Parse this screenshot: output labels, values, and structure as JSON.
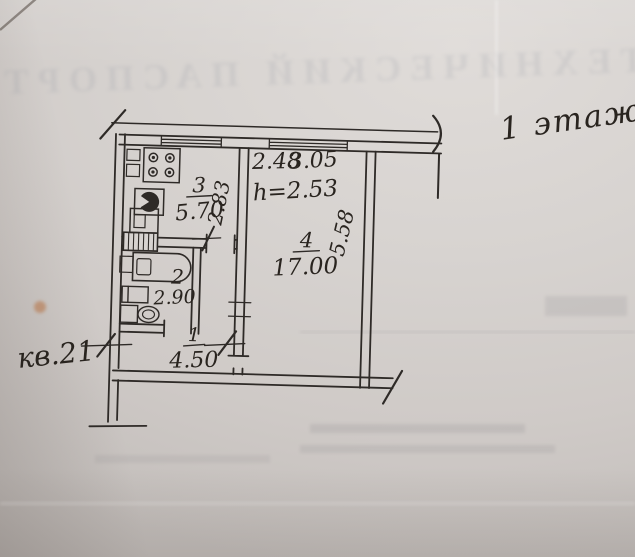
{
  "page": {
    "floor_note": "1 этаж",
    "apartment_note": "кв.21",
    "bleed_header": "ТЕХНИЧЕСКИЙ ПАСПОРТ",
    "paper_color": "#d7d3d0",
    "ink_color": "#2e2a27",
    "stain_color": "#b5703f"
  },
  "plan": {
    "dims": {
      "kitchen_width": "2.48",
      "kitchen_depth": "2.83",
      "living_width": "3.05",
      "living_depth": "5.58",
      "ceiling_height": "h=2.53"
    },
    "rooms": {
      "hall": {
        "number": "1",
        "area": "4.50"
      },
      "bathroom": {
        "number": "2",
        "area": "2.90"
      },
      "kitchen": {
        "number": "3",
        "area": "5.70"
      },
      "living": {
        "number": "4",
        "area": "17.00"
      }
    }
  }
}
